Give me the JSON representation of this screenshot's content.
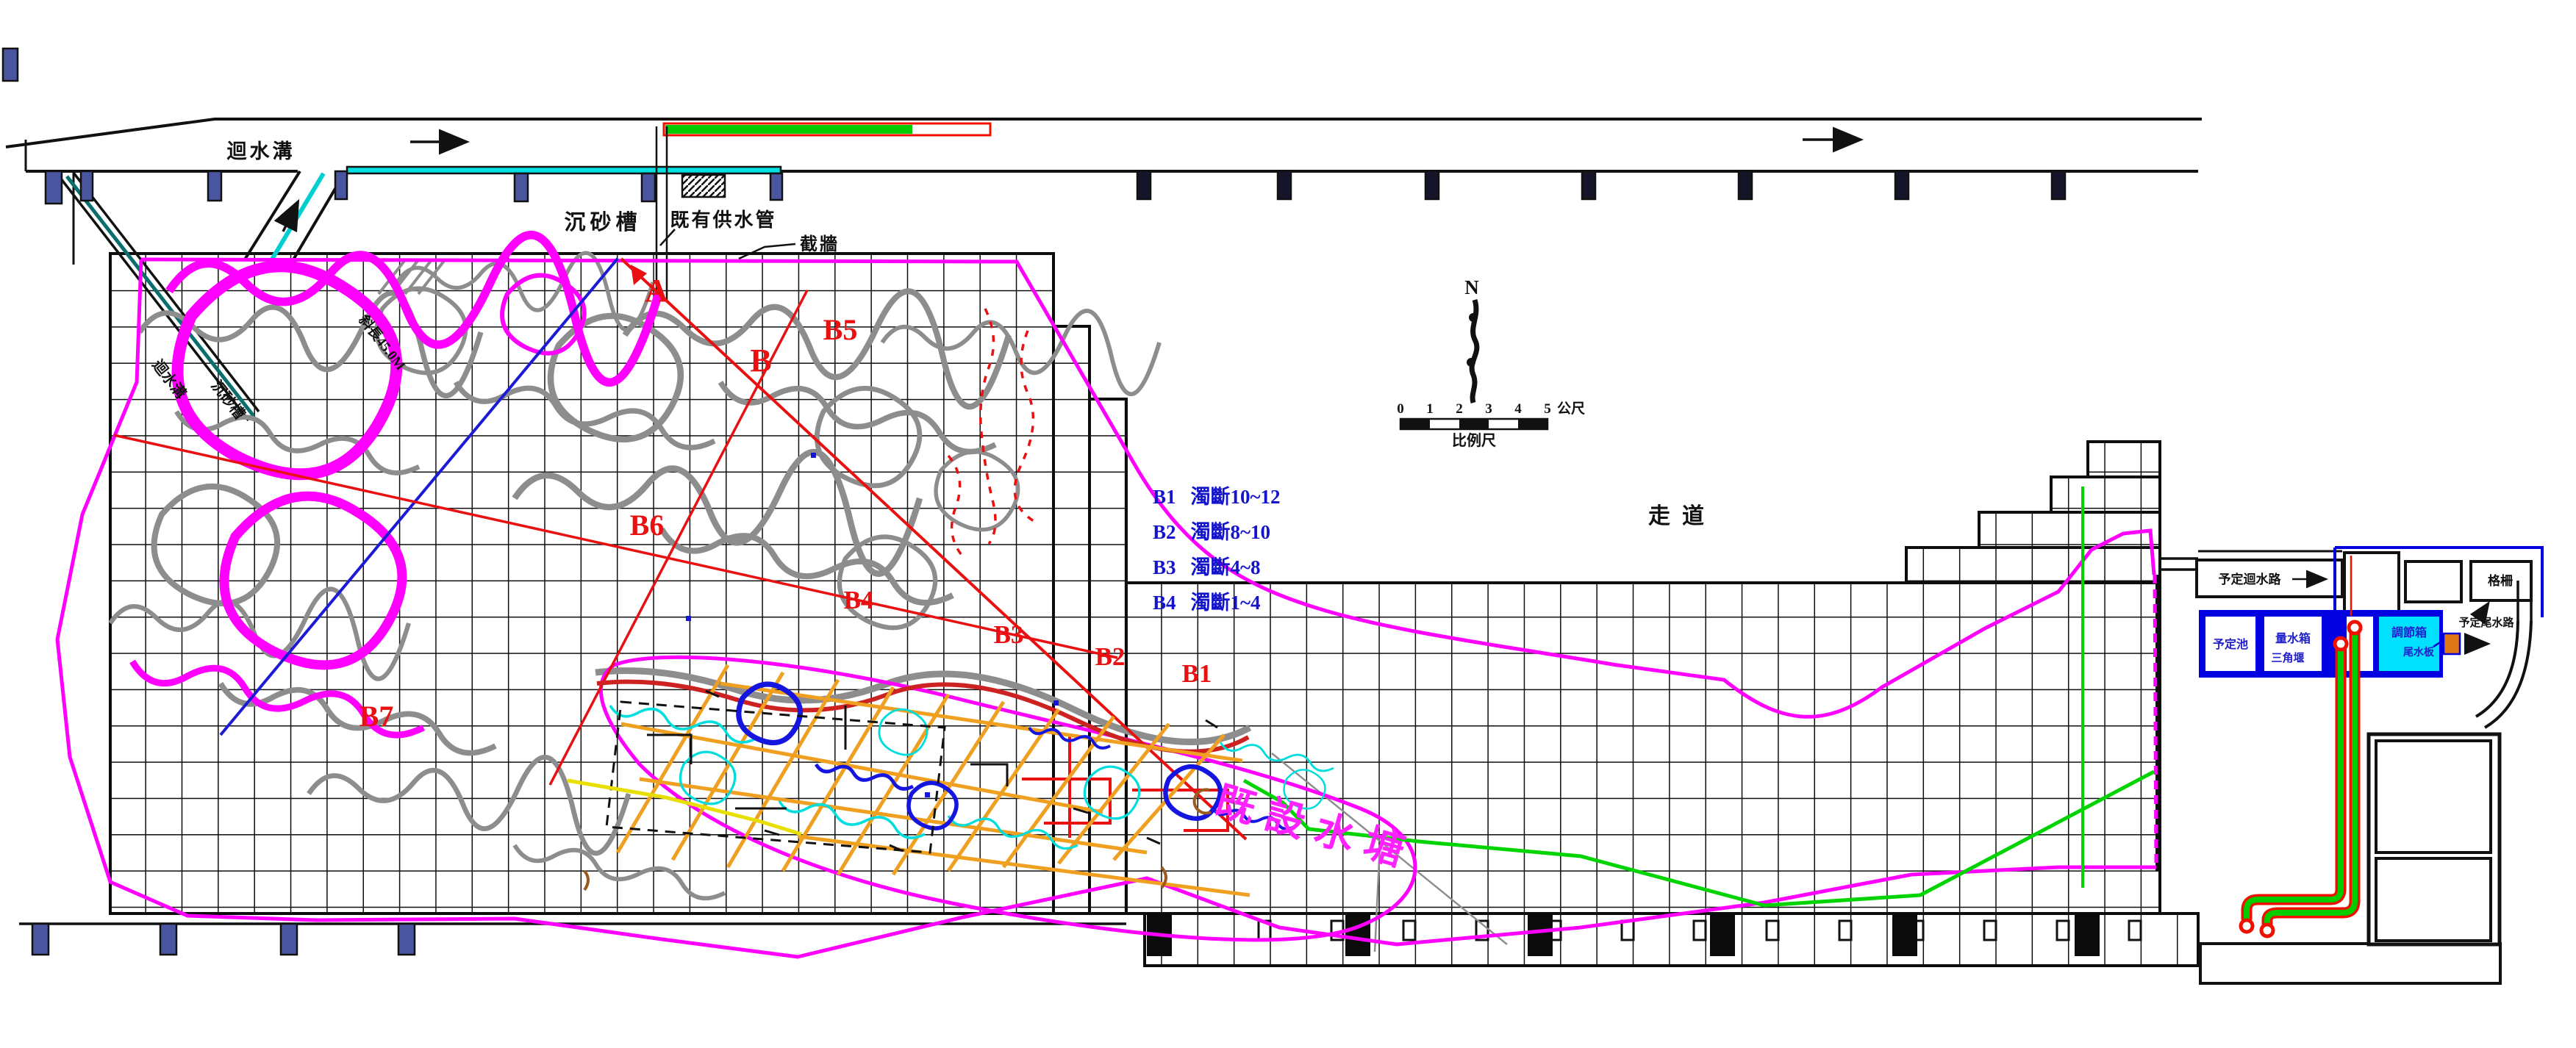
{
  "drawing": {
    "top": {
      "return_ditch": "迴水溝",
      "sand_trap": "沉砂槽",
      "existing_supply_pipe": "既有供水管",
      "cutoff_wall": "截牆",
      "slope_note": "斜長45.0M",
      "strip_label_upper": "迴水溝",
      "strip_label_lower": "沉砂槽"
    },
    "zones": {
      "a": "A",
      "b": "B",
      "b1": "B1",
      "b2": "B2",
      "b3": "B3",
      "b4": "B4",
      "b5": "B5",
      "b6": "B6",
      "b7": "B7"
    },
    "legend": {
      "items": [
        {
          "code": "B1",
          "desc": "濁斷10~12"
        },
        {
          "code": "B2",
          "desc": "濁斷8~10"
        },
        {
          "code": "B3",
          "desc": "濁斷4~8"
        },
        {
          "code": "B4",
          "desc": "濁斷1~4"
        }
      ]
    },
    "walkway": "走道",
    "pond_label": "既設水塘",
    "north_label": "N",
    "scale_bar": {
      "ticks": [
        "0",
        "1",
        "2",
        "3",
        "4",
        "5"
      ],
      "unit": "公尺",
      "caption": "比例尺"
    },
    "right_plant": {
      "planned_return_channel": "予定迴水路",
      "screen": "格柵",
      "planned_pond": "予定池",
      "measuring_tank": "量水箱",
      "v_notch_weir": "三角堰",
      "regulating_box": "調節箱",
      "tailwater_board": "尾水板",
      "planned_tailrace": "予定尾水路"
    }
  }
}
